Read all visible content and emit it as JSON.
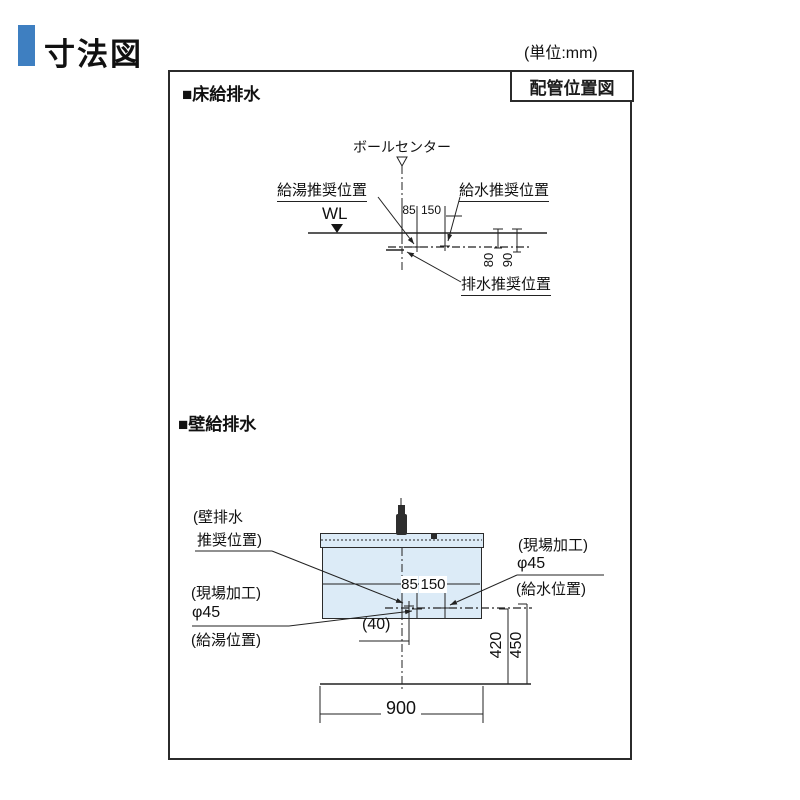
{
  "page": {
    "title": "寸法図",
    "unit": "(単位:mm)"
  },
  "panel": {
    "corner_label": "配管位置図"
  },
  "floor_section": {
    "heading": "■床給排水",
    "labels": {
      "bowl_center": "ボールセンター",
      "hot_water": "給湯推奨位置",
      "cold_water": "給水推奨位置",
      "water_line": "WL",
      "drain": "排水推奨位置"
    },
    "dims": {
      "d85": "85",
      "d150": "150",
      "d80": "80",
      "d90": "90"
    }
  },
  "wall_section": {
    "heading": "■壁給排水",
    "labels": {
      "wall_drain_line1": "(壁排水",
      "wall_drain_line2": "推奨位置)",
      "site_work_left": "(現場加工)",
      "phi_left": "φ45",
      "hot_pos": "(給湯位置)",
      "site_work_right": "(現場加工)",
      "phi_right": "φ45",
      "cold_pos": "(給水位置)"
    },
    "dims": {
      "d85": "85",
      "d150": "150",
      "d40": "(40)",
      "d420": "420",
      "d450": "450",
      "d900": "900"
    }
  },
  "colors": {
    "accent": "#3e7fc1",
    "line": "#222222",
    "cabinet_fill": "#dcebf7"
  }
}
